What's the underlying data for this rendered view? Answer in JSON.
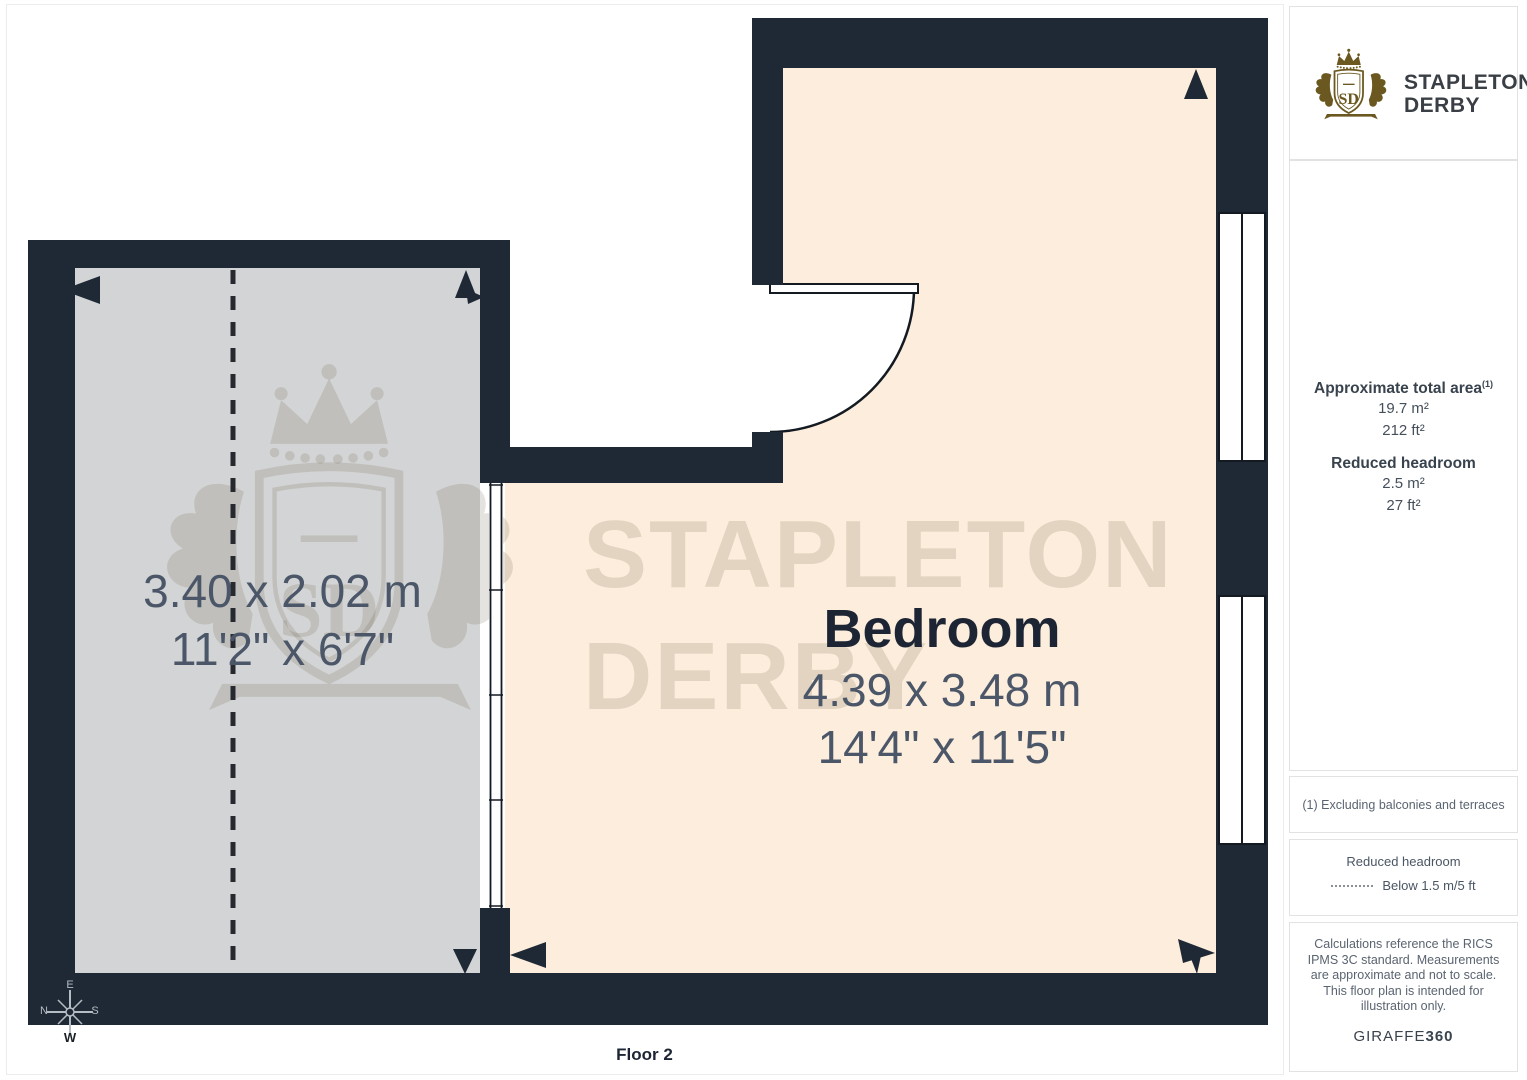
{
  "branding": {
    "name_line1": "STAPLETON",
    "name_line2": "DERBY",
    "monogram": "SD",
    "gold": "#6A5820"
  },
  "floorplan": {
    "floor_label": "Floor 2",
    "watermark": {
      "line1": "STAPLETON",
      "line2": "DERBY",
      "monogram": "SD"
    },
    "rooms": [
      {
        "name": "",
        "dims_metric": "3.40 x 2.02 m",
        "dims_imperial": "11'2\" x 6'7\""
      },
      {
        "name": "Bedroom",
        "dims_metric": "4.39 x 3.48 m",
        "dims_imperial": "14'4\" x 11'5\""
      }
    ],
    "compass": {
      "top": "E",
      "left": "N",
      "right": "S",
      "bottom": "W"
    }
  },
  "sidebar": {
    "area_title": "Approximate total area",
    "area_footnote_marker": "(1)",
    "area_m2": "19.7 m²",
    "area_ft2": "212 ft²",
    "reduced_title": "Reduced headroom",
    "reduced_m2": "2.5 m²",
    "reduced_ft2": "27 ft²",
    "footnote": "(1) Excluding balconies and terraces",
    "legend_title": "Reduced headroom",
    "legend_label": "Below 1.5 m/5 ft",
    "disclaimer": "Calculations reference the RICS IPMS 3C standard. Measurements are approximate and not to scale. This floor plan is intended for illustration only.",
    "brand_footer_normal": "GIRAFFE",
    "brand_footer_bold": "360"
  },
  "colors": {
    "wall": "#1F2936",
    "room_gray_floor": "#D3D4D5",
    "room_cream_floor": "#FCEDDC",
    "dimension_text": "#4B5768",
    "room_title_text": "#1D2534"
  }
}
